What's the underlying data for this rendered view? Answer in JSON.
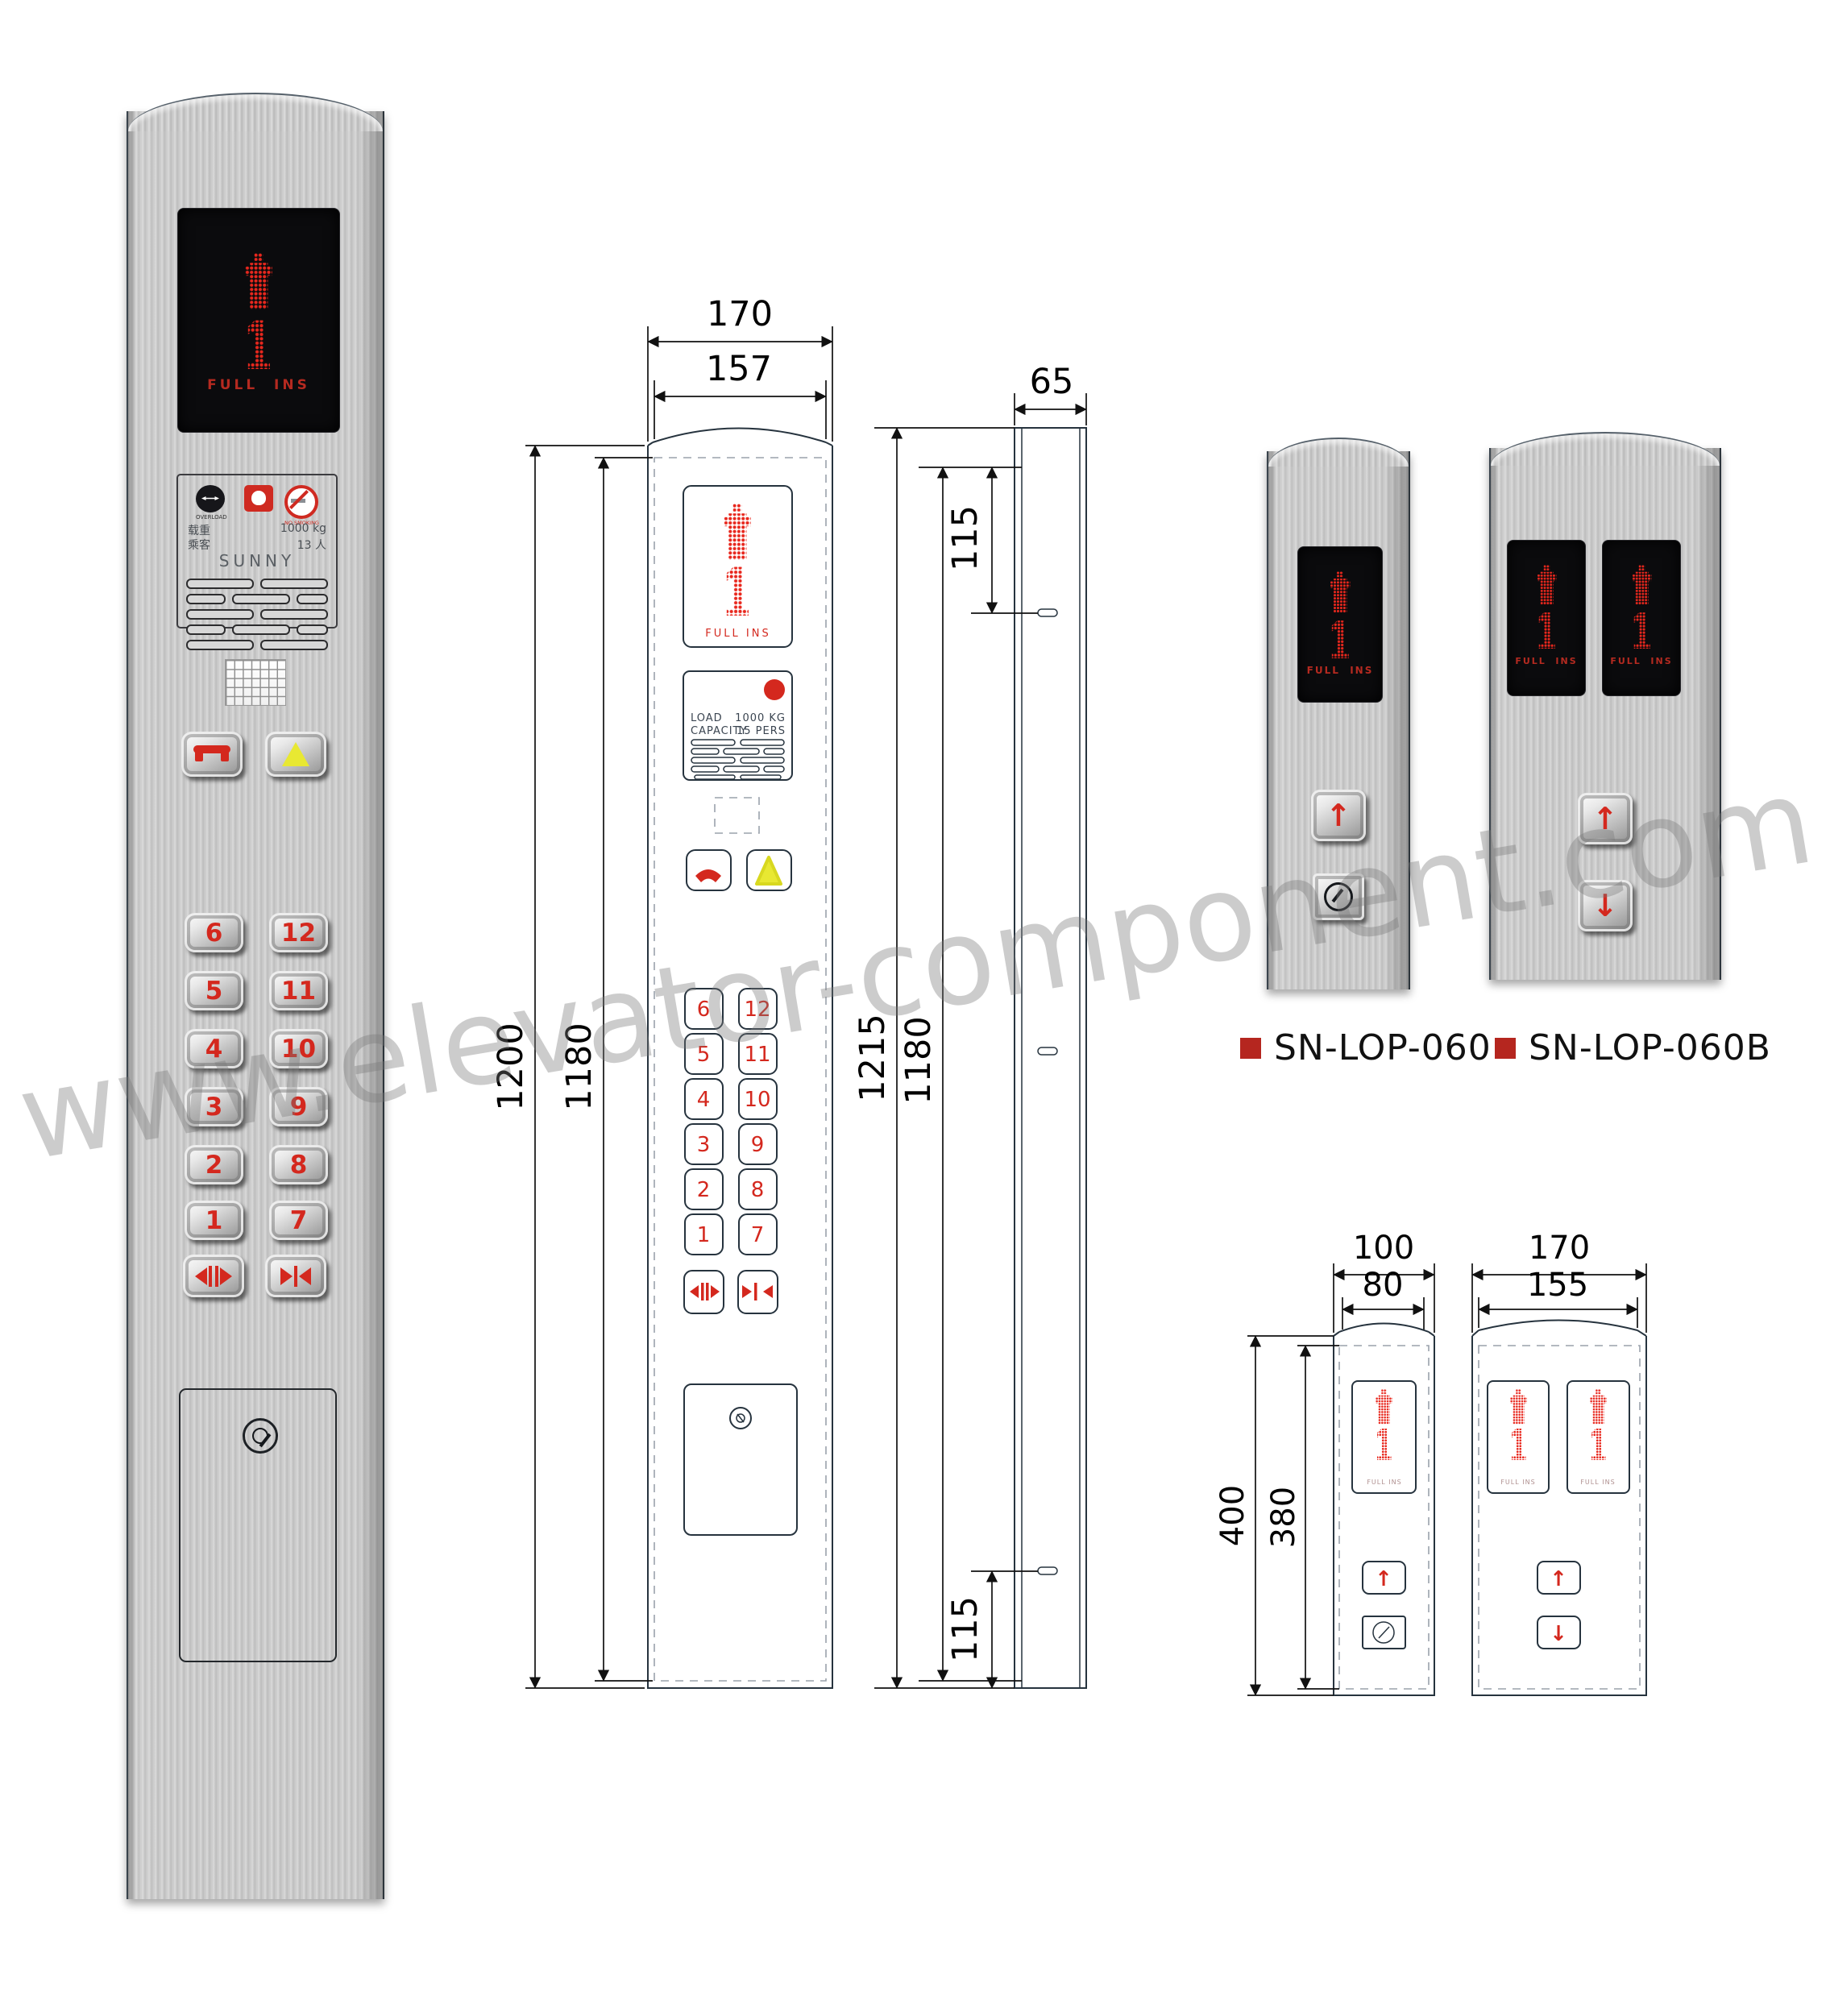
{
  "watermark": "www.elevator-component.com",
  "display": {
    "floor": "1",
    "status": "FULL  INS"
  },
  "floors": {
    "left": [
      "6",
      "5",
      "4",
      "3",
      "2",
      "1"
    ],
    "right": [
      "12",
      "11",
      "10",
      "9",
      "8",
      "7"
    ]
  },
  "cop_label": {
    "overload_caption": "OVERLOAD",
    "no_smoking_caption": "NO SMOKING",
    "load_name": "载重",
    "load_value": "1000 kg",
    "passenger_name": "乘客",
    "passenger_value": "13 人",
    "brand": "SUNNY"
  },
  "front_view": {
    "plate": {
      "load_label": "LOAD",
      "load_value": "1000 KG",
      "capacity_label": "CAPACITY",
      "capacity_value": "15 PERS"
    },
    "dims": {
      "width_outer": "170",
      "width_inner": "157",
      "height_outer": "1200",
      "height_inner": "1180"
    }
  },
  "side_view": {
    "dims": {
      "depth": "65",
      "height_outer": "1215",
      "height_inner": "1180",
      "hole_offset_top": "115",
      "hole_offset_bottom": "115"
    }
  },
  "products": [
    {
      "model": "SN-LOP-060"
    },
    {
      "model": "SN-LOP-060B"
    }
  ],
  "lop_drawing": {
    "dims": {
      "narrow_width_outer": "100",
      "narrow_width_inner": "80",
      "wide_width_outer": "170",
      "wide_width_inner": "155",
      "height_outer": "400",
      "height_inner": "380"
    }
  },
  "colors": {
    "led_red": "#e8271d",
    "accent_red": "#b5261f",
    "alarm_yellow": "#e8e832",
    "drawing_line": "#26333e"
  }
}
